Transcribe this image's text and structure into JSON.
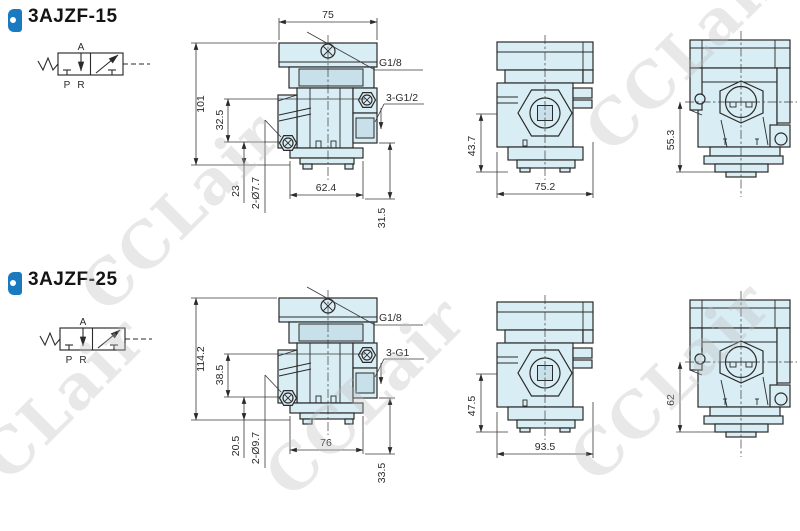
{
  "watermark": {
    "text": "CCLair"
  },
  "colors": {
    "body_fill": "#d9edf4",
    "body_shade": "#c7e0ea",
    "line": "#2a2a2a",
    "dim": "#3a3a3a",
    "accent_blue": "#1a7ac0",
    "watermark": "#bdbdbd",
    "title": "#141414"
  },
  "models": [
    {
      "title": "3AJZF-15",
      "symbol": {
        "a": "A",
        "p": "P",
        "r": "R"
      },
      "front": {
        "top_width": "75",
        "height": "101",
        "inner_height": "32.5",
        "lower_height": "23",
        "holes": "2-Ø7.7",
        "bottom_width": "62.4",
        "right_height": "31.5",
        "port_top": "G1/8",
        "ports_side": "3-G1/2"
      },
      "side": {
        "height": "43.7",
        "width": "75.2"
      },
      "end": {
        "height": "55.3"
      }
    },
    {
      "title": "3AJZF-25",
      "symbol": {
        "a": "A",
        "p": "P",
        "r": "R"
      },
      "front": {
        "height": "114.2",
        "inner_height": "38.5",
        "lower_height": "20.5",
        "holes": "2-Ø9.7",
        "bottom_width": "76",
        "right_height": "33.5",
        "port_top": "G1/8",
        "ports_side": "3-G1"
      },
      "side": {
        "height": "47.5",
        "width": "93.5"
      },
      "end": {
        "height": "62"
      }
    }
  ]
}
